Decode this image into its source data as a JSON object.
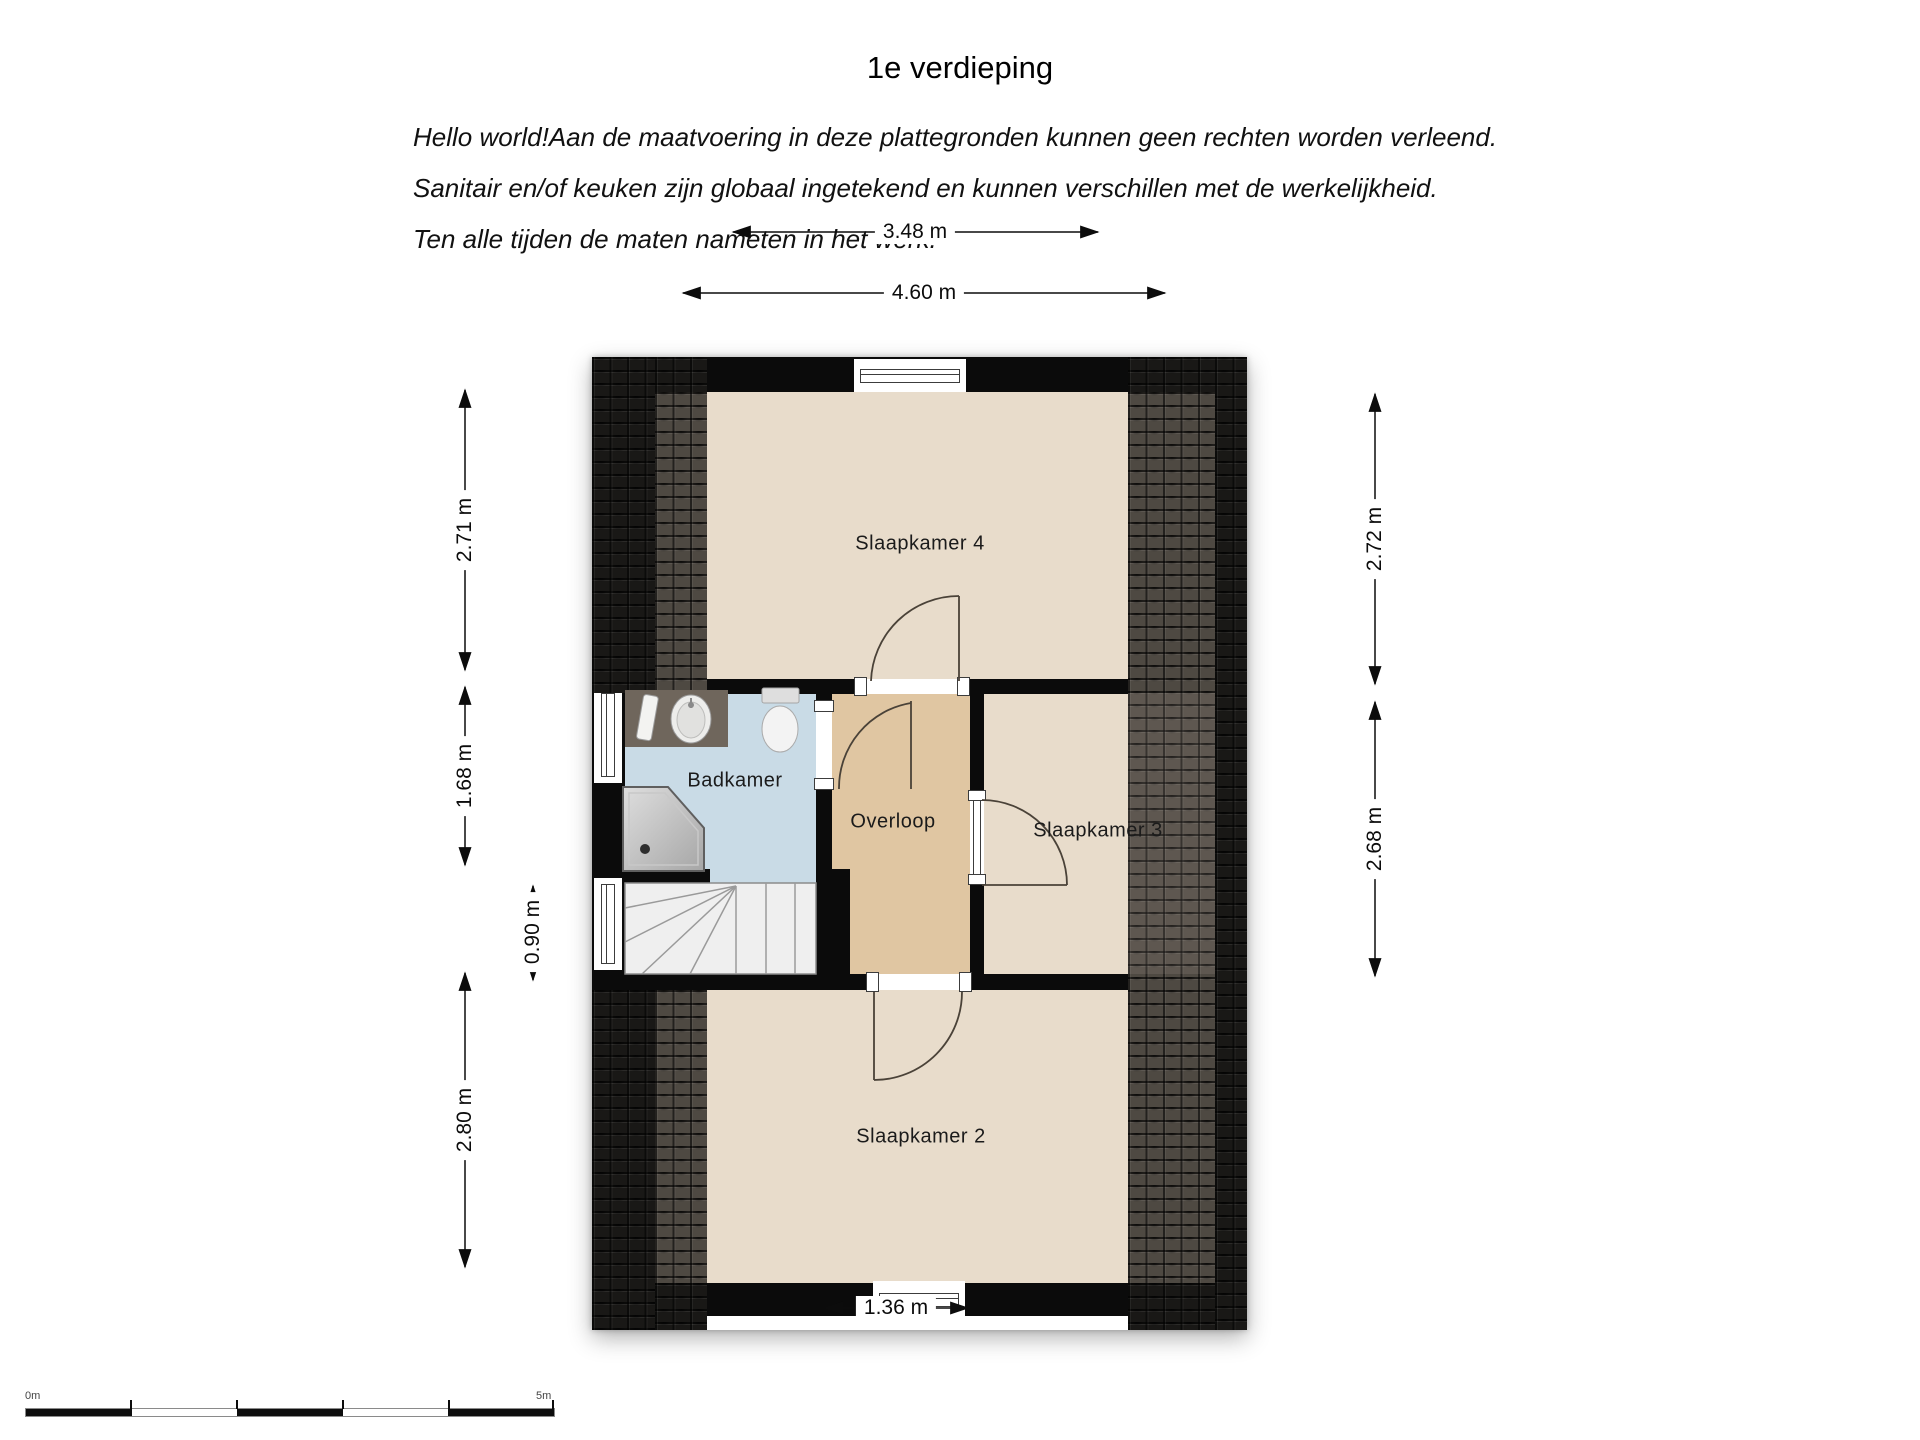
{
  "title": "1e verdieping",
  "disclaimer_lines": [
    "Hello world!Aan de maatvoering in deze plattegronden kunnen geen rechten worden verleend.",
    "Sanitair en/of keuken zijn globaal ingetekend en kunnen verschillen met de werkelijkheid.",
    "Ten alle tijden de maten nameten in het werk."
  ],
  "rooms": {
    "slaapkamer4": "Slaapkamer 4",
    "badkamer": "Badkamer",
    "overloop": "Overloop",
    "slaapkamer3": "Slaapkamer 3",
    "slaapkamer2": "Slaapkamer 2"
  },
  "dimensions": {
    "top_inner": "3.48 m",
    "top_outer": "4.60 m",
    "left_upper": "2.71 m",
    "left_middle": "1.68 m",
    "left_lower": "2.80 m",
    "stair_width": "0.90 m",
    "right_upper": "2.72 m",
    "right_lower": "2.68 m",
    "bottom": "1.36 m"
  },
  "scale_bar": {
    "start_label": "0m",
    "end_label": "5m"
  },
  "colors": {
    "floor_bedroom": "#e8dccb",
    "floor_hall": "#e0c6a2",
    "floor_bath": "#c9dbe6",
    "wall": "#0b0b0b",
    "roof_dark": "#191816",
    "roof_light": "#4e4942",
    "fixture_counter": "#6f665c"
  }
}
